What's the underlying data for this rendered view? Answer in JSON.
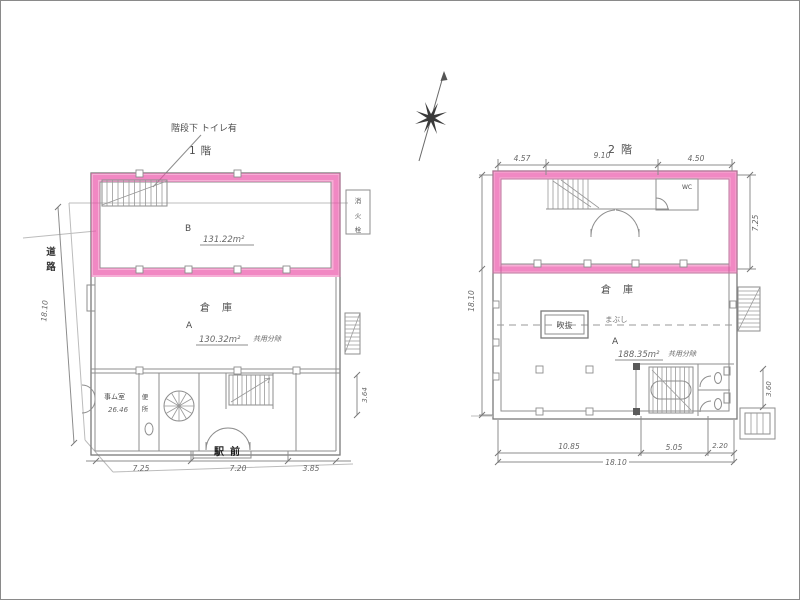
{
  "colors": {
    "highlight_pink": "#ee5fae",
    "pencil_line": "#8d8d8d",
    "ink": "#4d4d4d",
    "stamp_ink": "#1f1f1f"
  },
  "icons": {
    "compass": "north-arrow"
  },
  "floor1": {
    "title": "1階",
    "stair_note": "階段下 トイレ有",
    "road_chars": [
      "道",
      "路"
    ],
    "front_stamp": "駅前",
    "hydrant_chars": [
      "消",
      "火",
      "栓"
    ],
    "warehouse_label": "倉庫",
    "room_b": {
      "label": "B",
      "area": "131.22m²"
    },
    "room_a": {
      "label": "A",
      "area": "130.32m²",
      "note": "共用分除"
    },
    "office": {
      "label": "事ム室",
      "area": "26.46"
    },
    "toilet_chars": [
      "便",
      "所"
    ],
    "dims": {
      "bottom": [
        "7.25",
        "7.20",
        "3.85"
      ],
      "left_vertical": "18.10",
      "right_vertical": "3.64"
    }
  },
  "floor2": {
    "title": "2階",
    "warehouse_label": "倉庫",
    "void_label": "吹抜",
    "line_note": "まぶし",
    "wc_label": "WC",
    "room_a": {
      "label": "A",
      "area": "188.35m²",
      "note": "共用分除"
    },
    "dims": {
      "top": [
        "4.57",
        "9.10",
        "4.50"
      ],
      "bottom": [
        "10.85",
        "5.05",
        "2.20"
      ],
      "bottom_total": "18.10",
      "left_vertical": "18.10",
      "right_upper": "7.25",
      "right_lower": "3.60"
    }
  }
}
